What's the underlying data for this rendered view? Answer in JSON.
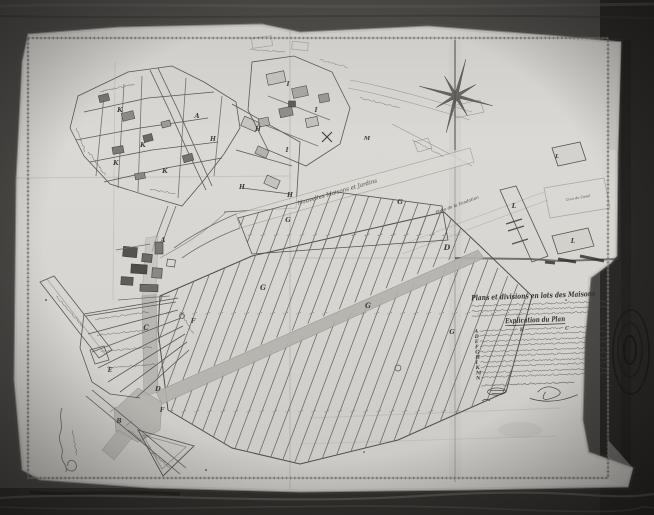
{
  "map": {
    "title": "Plans et divisions en lots des Maisons",
    "legend_heading": "Explication du Plan",
    "legend_rows": [
      [
        "A",
        "B",
        "C"
      ],
      [
        "D"
      ],
      [
        "E"
      ],
      [
        "F"
      ],
      [
        "G"
      ],
      [
        "H"
      ],
      [
        "I"
      ],
      [
        "K"
      ],
      [
        "M"
      ],
      [
        "N"
      ]
    ],
    "compass": {
      "icon": "compass-star",
      "points": 8
    },
    "street_labels": [
      {
        "t": "Nouvelles Maisons et Jardins",
        "x": 298,
        "y": 205,
        "r": -16,
        "s": 5.6
      },
      {
        "t": "Place de la Fondation",
        "x": 436,
        "y": 214,
        "r": -20,
        "s": 4.2
      },
      {
        "t": "Cour du Canal",
        "x": 566,
        "y": 201,
        "r": -10,
        "s": 3.4
      }
    ],
    "plot_labels": [
      {
        "t": "K",
        "x": 120,
        "y": 112,
        "s": 6.5
      },
      {
        "t": "K",
        "x": 143,
        "y": 147,
        "s": 6.5
      },
      {
        "t": "K",
        "x": 116,
        "y": 165,
        "s": 6.5
      },
      {
        "t": "K",
        "x": 165,
        "y": 173,
        "s": 6.5
      },
      {
        "t": "A",
        "x": 197,
        "y": 118,
        "s": 6.5
      },
      {
        "t": "A",
        "x": 163,
        "y": 242,
        "s": 6
      },
      {
        "t": "H",
        "x": 213,
        "y": 141,
        "s": 6
      },
      {
        "t": "H",
        "x": 258,
        "y": 131,
        "s": 6
      },
      {
        "t": "H",
        "x": 242,
        "y": 189,
        "s": 6
      },
      {
        "t": "H",
        "x": 290,
        "y": 197,
        "s": 6
      },
      {
        "t": "I",
        "x": 288,
        "y": 86,
        "s": 6
      },
      {
        "t": "I",
        "x": 316,
        "y": 112,
        "s": 6
      },
      {
        "t": "I",
        "x": 287,
        "y": 152,
        "s": 6
      },
      {
        "t": "M",
        "x": 367,
        "y": 140,
        "s": 5.5
      },
      {
        "t": "G",
        "x": 288,
        "y": 222,
        "s": 6.5
      },
      {
        "t": "G",
        "x": 400,
        "y": 204,
        "s": 6.5
      },
      {
        "t": "G",
        "x": 263,
        "y": 290,
        "s": 7
      },
      {
        "t": "G",
        "x": 368,
        "y": 308,
        "s": 7
      },
      {
        "t": "G",
        "x": 452,
        "y": 334,
        "s": 6.5
      },
      {
        "t": "D",
        "x": 447,
        "y": 250,
        "s": 7.5
      },
      {
        "t": "D",
        "x": 158,
        "y": 391,
        "s": 6.5
      },
      {
        "t": "C",
        "x": 146,
        "y": 330,
        "s": 7
      },
      {
        "t": "F",
        "x": 193,
        "y": 323,
        "s": 6.5
      },
      {
        "t": "F",
        "x": 162,
        "y": 412,
        "s": 6
      },
      {
        "t": "E",
        "x": 110,
        "y": 372,
        "s": 6
      },
      {
        "t": "B",
        "x": 119,
        "y": 423,
        "s": 6
      },
      {
        "t": "L",
        "x": 514,
        "y": 208,
        "s": 6.5
      },
      {
        "t": "L",
        "x": 573,
        "y": 243,
        "s": 6
      },
      {
        "t": "L",
        "x": 557,
        "y": 158,
        "s": 5.5
      }
    ],
    "colors": {
      "wood": "#4b4946",
      "wood_dark": "#262422",
      "paper": "#d7d5d1",
      "ink": "#45433f",
      "road_fill": "#b4b2ad",
      "border": "#716f6a"
    }
  }
}
